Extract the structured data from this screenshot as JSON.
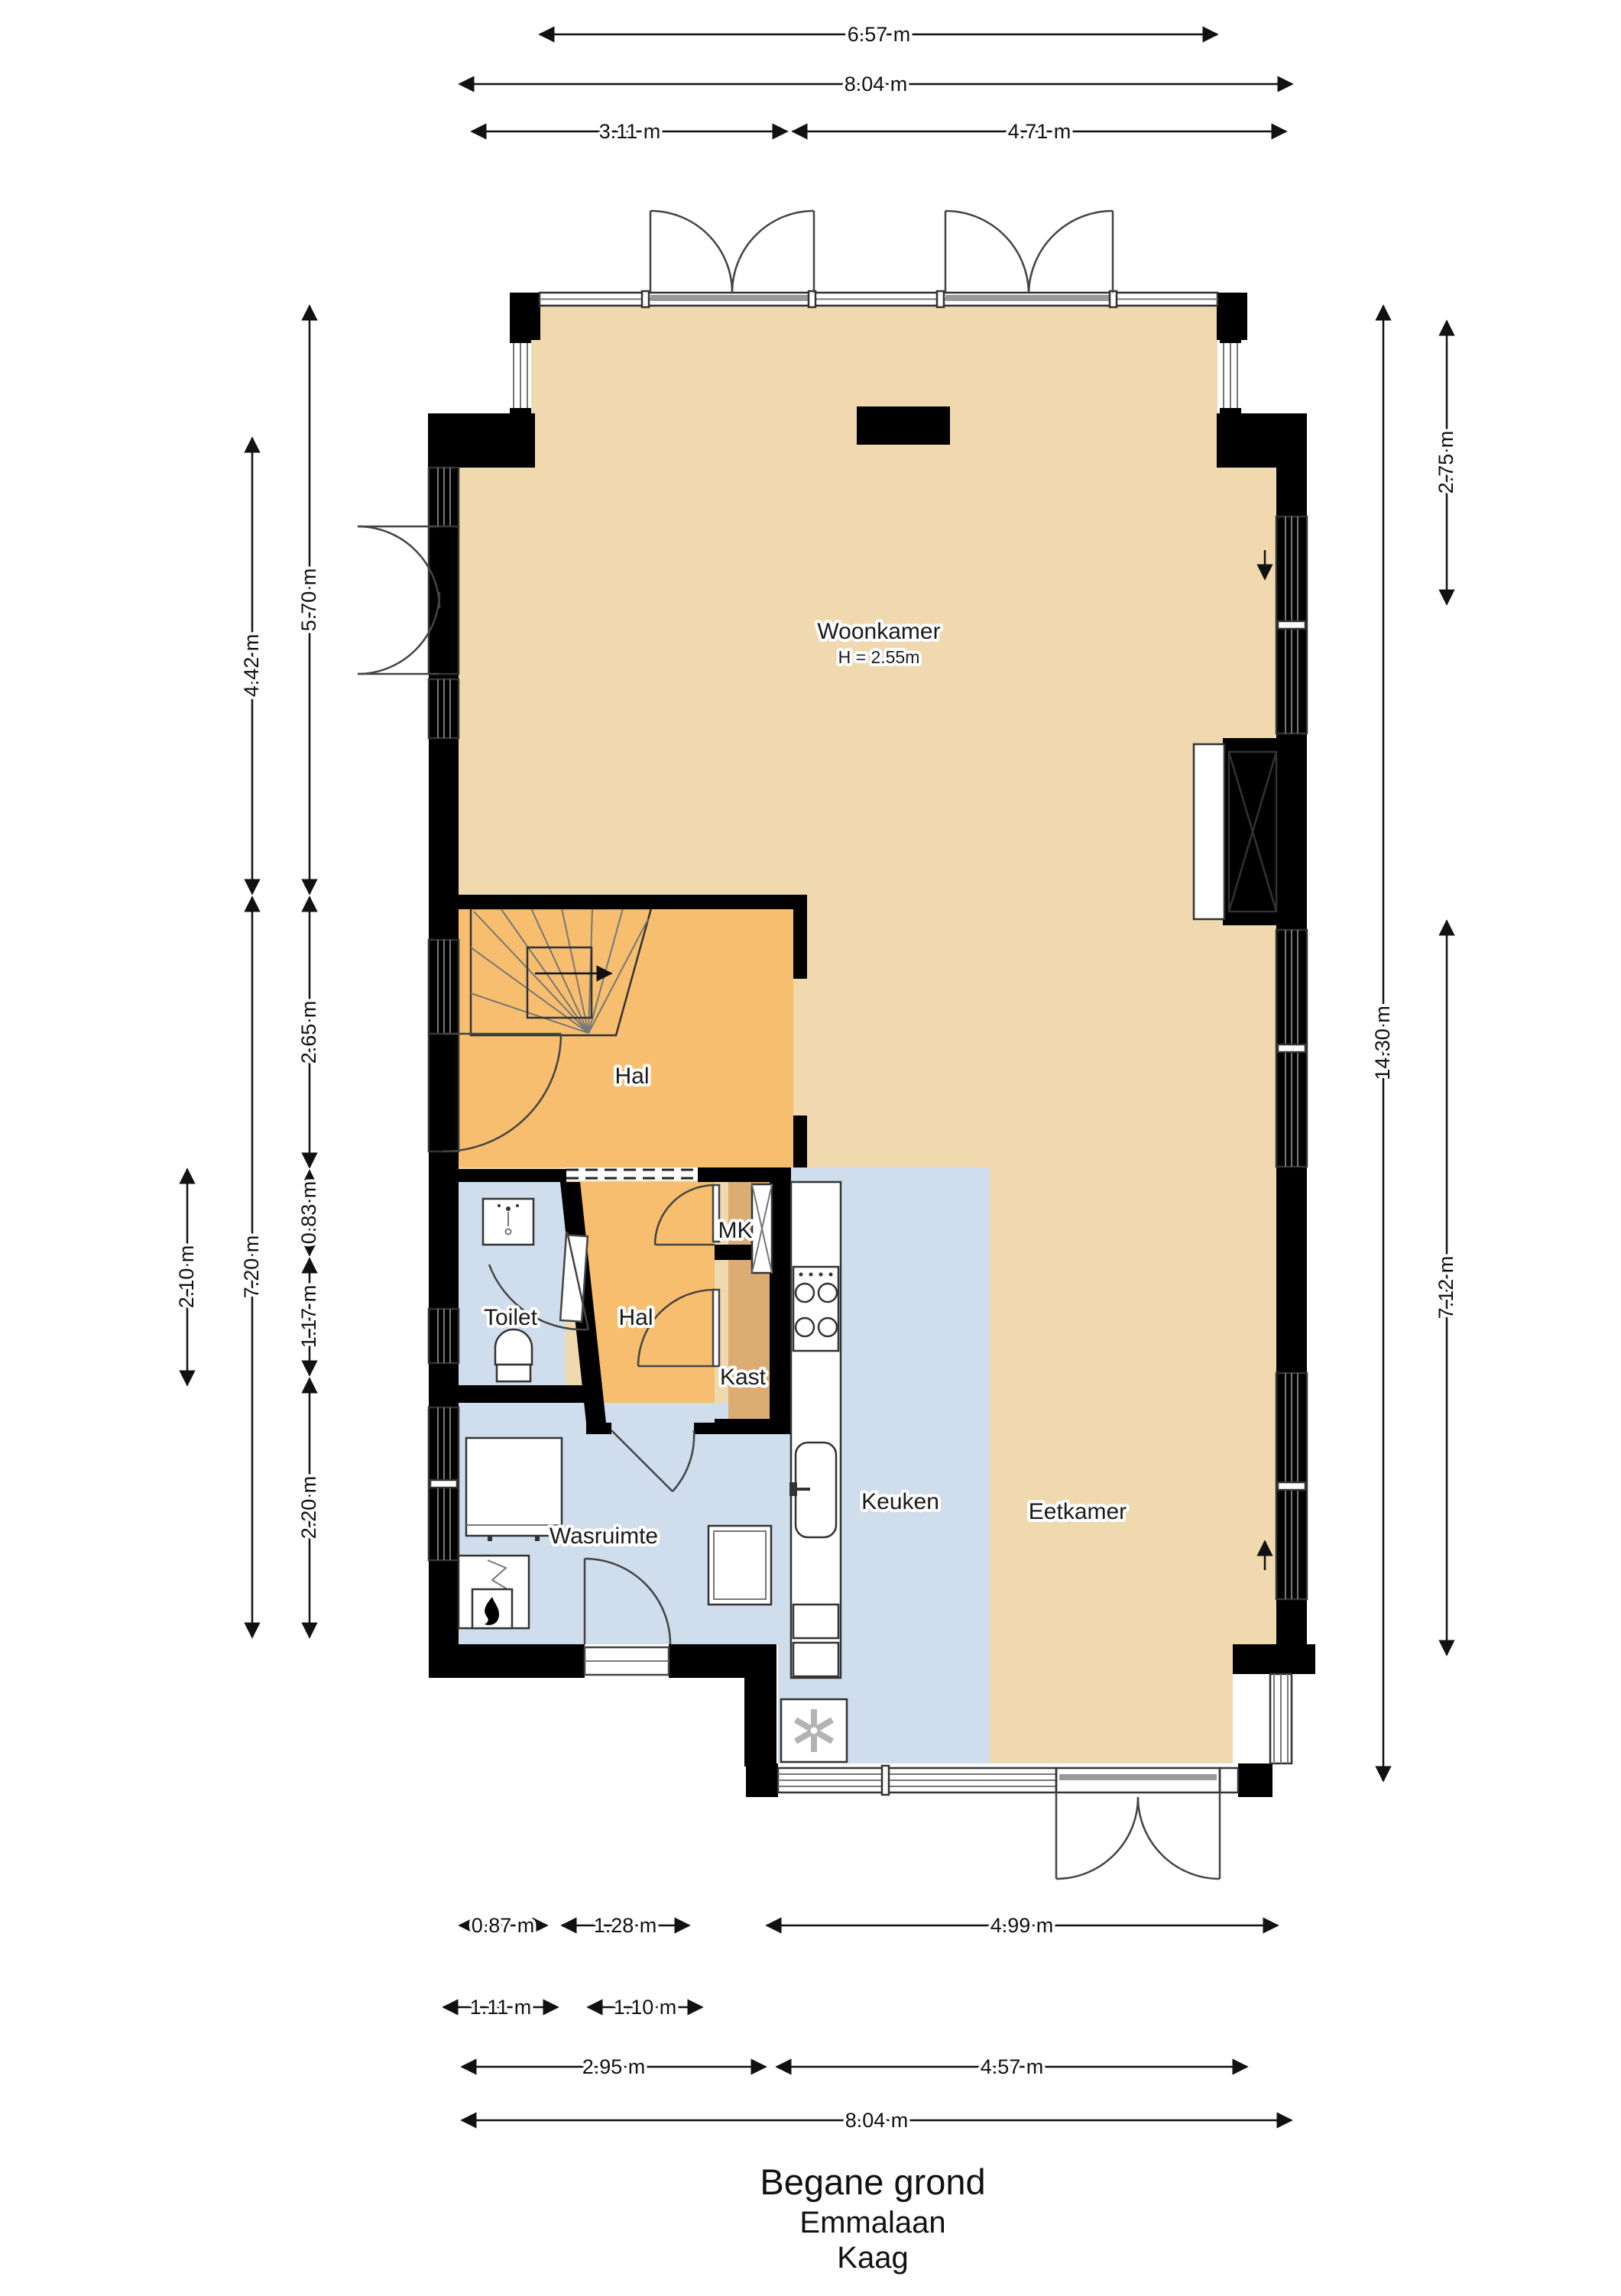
{
  "title": {
    "floor": "Begane grond",
    "street": "Emmalaan",
    "city": "Kaag"
  },
  "rooms": {
    "woonkamer": {
      "label": "Woonkamer",
      "ceiling_note": "H = 2.55m"
    },
    "hal_upper": {
      "label": "Hal"
    },
    "hal_lower": {
      "label": "Hal"
    },
    "toilet": {
      "label": "Toilet"
    },
    "mk": {
      "label": "MK"
    },
    "kast": {
      "label": "Kast"
    },
    "keuken": {
      "label": "Keuken"
    },
    "eetkamer": {
      "label": "Eetkamer"
    },
    "wasruimte": {
      "label": "Wasruimte"
    }
  },
  "dimensions": {
    "top": {
      "inner_width": "6.57 m",
      "total_width": "8.04 m",
      "left_section": "3.11 m",
      "right_section": "4.71 m"
    },
    "left": {
      "upper": "5.70 m",
      "woonkamer": "4.42 m",
      "hal": "2.65 m",
      "seg_083": "0.83 m",
      "lower": "7.20 m",
      "toilet": "2.10 m",
      "seg_117": "1.17 m",
      "wasruimte": "2.20 m"
    },
    "right": {
      "upper_window": "2.75 m",
      "total_height": "14.30 m",
      "lower": "7.12 m"
    },
    "bottom": {
      "seg_087": "0.87 m",
      "seg_128": "1.28 m",
      "keuken_door": "4.99 m",
      "seg_111": "1.11 m",
      "seg_110": "1.10 m",
      "left_section": "2.95 m",
      "right_section": "4.57 m",
      "total_width": "8.04 m"
    }
  },
  "colors": {
    "floor_main": "#f0d9ae",
    "floor_hall": "#f6be6e",
    "floor_closet": "#dcad72",
    "floor_wet": "#cfdded",
    "wall": "#000000"
  }
}
